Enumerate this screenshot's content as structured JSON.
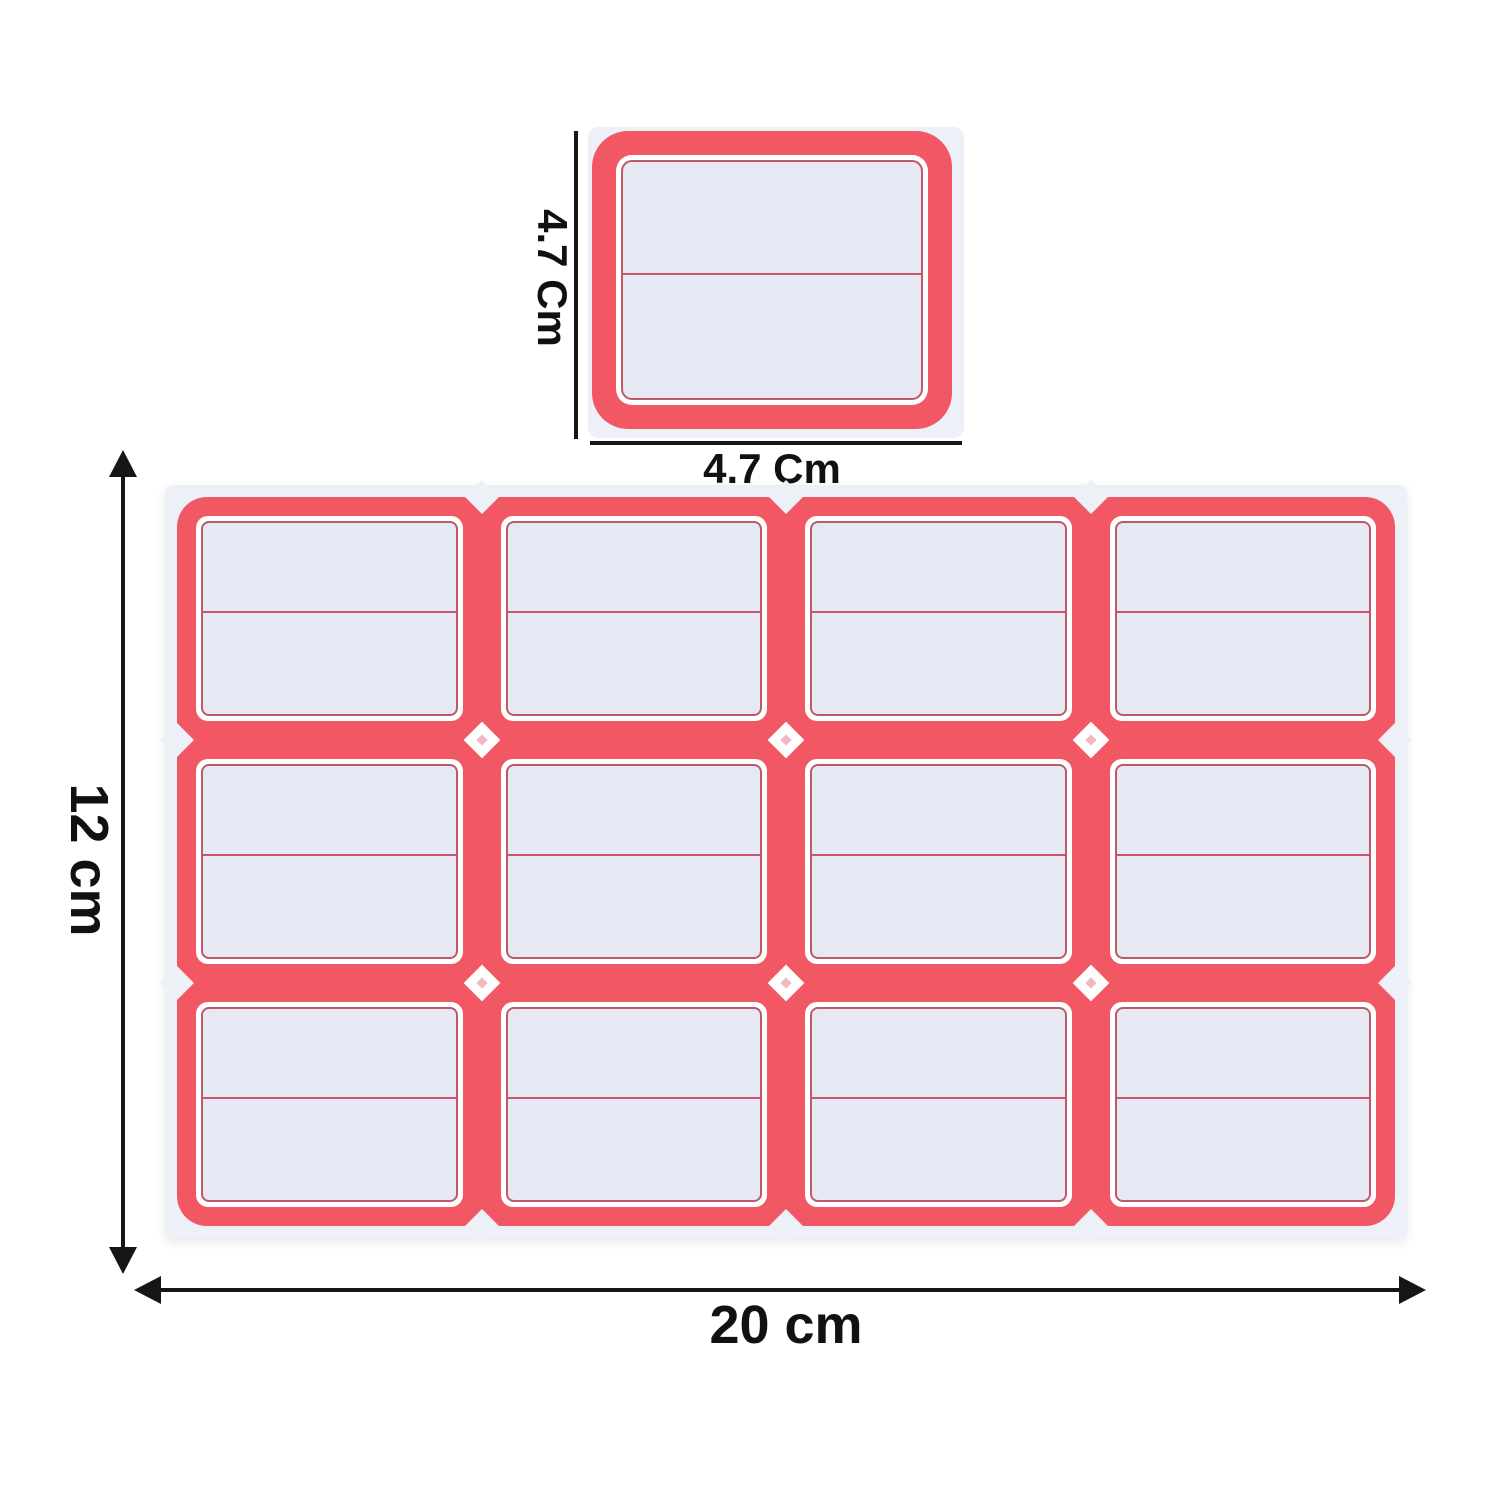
{
  "diagram": {
    "single_label": {
      "height_dimension": "4.7 Cm",
      "width_dimension": "4.7 Cm"
    },
    "sheet": {
      "rows": 3,
      "columns": 4,
      "label_count": 12,
      "height_dimension": "12 cm",
      "width_dimension": "20 cm"
    },
    "colors": {
      "label_red": "#f15864",
      "label_inner_line": "#bd5a66",
      "label_fill": "#e6e8f3",
      "divider_line": "#cc5668",
      "sheet_backing": "#eef0f8",
      "dimension_ink": "#161616",
      "background": "#ffffff"
    }
  }
}
